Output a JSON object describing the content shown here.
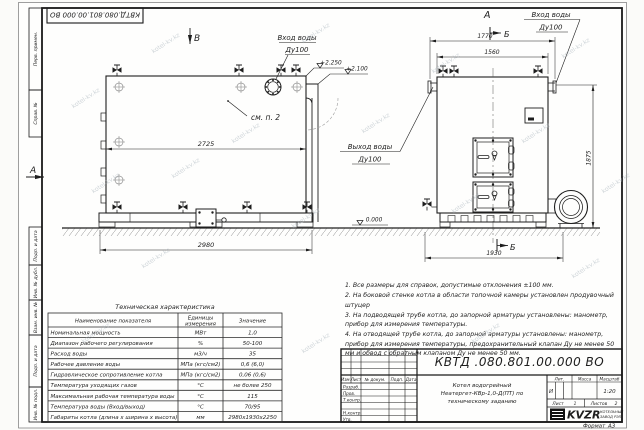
{
  "doc": {
    "number": "КВТД.080.801.00.000 ВО",
    "number_stamp": "КВТД.080.801.00.000 ВО",
    "format_label": "Формат",
    "format_value": "А3"
  },
  "watermark": "kotel-kv.kz",
  "frame": {
    "left_top_cells": [
      "Перв. примен.",
      "Справ. №"
    ],
    "left_bottom_cells": [
      "Подп. и дата",
      "Инв. № дубл.",
      "Взам. инв. №",
      "Подп. и дата",
      "Инв. № подл."
    ]
  },
  "views": {
    "view_b_label": "В",
    "view_a_label": "А",
    "view_a_side_label": "А",
    "section_b_top": "Б",
    "section_b_bottom": "Б",
    "see_note": "см. п. 2",
    "inlet_label_1": "Вход воды",
    "inlet_label_2": "Ду100",
    "outlet_label_1": "Выход воды",
    "outlet_label_2": "Ду100",
    "level_top": "+2.250",
    "level_mid": "+2.100",
    "level_zero": "0.000"
  },
  "dims": {
    "side_inner": "2725",
    "side_length": "2980",
    "front_outer": "1770",
    "front_inner": "1560",
    "front_base": "1930",
    "height": "1875"
  },
  "notes": [
    "1.  Все размеры для справок, допустимые отклонения  ±100 мм.",
    "2.  На боковой стенке котла в области топочной камеры установлен продувочный штуцер",
    "3.  На подводящей трубе котла, до запорной арматуры установлены: манометр, прибор для измерения температуры.",
    "4.  На отводящей трубе котла, до запорной арматуры установлены: манометр, прибор для измерения температуры, предохранительный клапан Ду не менее 50 мм и обвод с обратным клапаном Ду не менее 50 мм."
  ],
  "tech_table": {
    "title": "Техническая характеристика",
    "header_name": "Наименование показателя",
    "header_unit_1": "Единицы",
    "header_unit_2": "измерения",
    "header_value": "Значение",
    "rows": [
      {
        "name": "Номинальная мощность",
        "unit": "МВт",
        "value": "1,0"
      },
      {
        "name": "Диапазон рабочего регулирования",
        "unit": "%",
        "value": "50-100"
      },
      {
        "name": "Расход воды",
        "unit": "м3/ч",
        "value": "35"
      },
      {
        "name": "Рабочее давление воды",
        "unit": "МПа (кгс/см2)",
        "value": "0,6 (6,0)"
      },
      {
        "name": "Гидравлическое сопротивление котла",
        "unit": "МПа (кгс/см2)",
        "value": "0,06 (0,6)"
      },
      {
        "name": "Температура уходящих газов",
        "unit": "°С",
        "value": "не более 250"
      },
      {
        "name": "Максимальная рабочая температура воды",
        "unit": "°С",
        "value": "115"
      },
      {
        "name": "Температура воды (Вход/выход)",
        "unit": "°С",
        "value": "70/95"
      },
      {
        "name": "Габариты котла (длина х ширина х высота)",
        "unit": "мм",
        "value": "2980х1930х2250"
      }
    ]
  },
  "title_block": {
    "designation": "КВТД .080.801.00.000  ВО",
    "rev_headers": [
      "Изм.",
      "Лист",
      "№ докум.",
      "Подп.",
      "Дата"
    ],
    "sig_rows": [
      "Разраб.",
      "Пров.",
      "Т.контр.",
      "Н.контр.",
      "Утв."
    ],
    "name_line_1": "Котел водогрейный",
    "name_line_2": "Неатергет-КВр-1,0-Д(ПТ) по",
    "name_line_3": "техническому заданию",
    "lit_header": "Лит.",
    "mass_header": "Масса",
    "scale_header": "Масштаб",
    "lit_value": "И",
    "scale_value": "1:20",
    "sheet_label": "Лист",
    "sheet_value": "1",
    "sheets_label": "Листов",
    "sheets_value": "2",
    "logo_text": "KVZR",
    "logo_caption_1": "КОТЕЛЬНЫЙ",
    "logo_caption_2": "ЗАВОД РЭП"
  }
}
